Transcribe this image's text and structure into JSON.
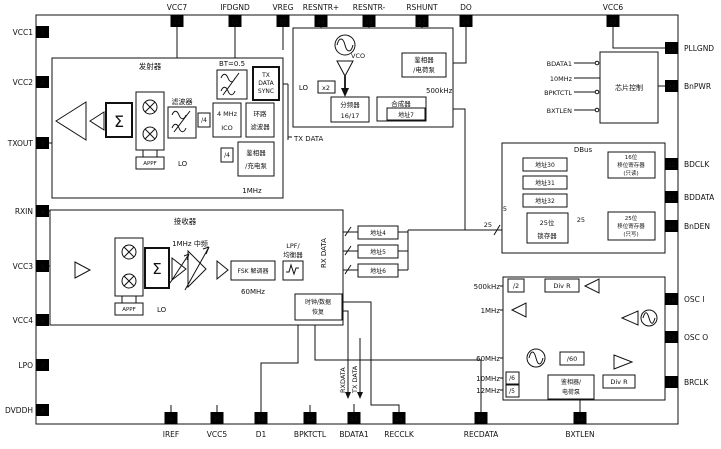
{
  "pins": {
    "left": [
      {
        "num": "1",
        "label": "VCC1"
      },
      {
        "num": "2",
        "label": "VCC2"
      },
      {
        "num": "3",
        "label": "TXOUT"
      },
      {
        "num": "4",
        "label": "RXIN"
      },
      {
        "num": "5",
        "label": "VCC3"
      },
      {
        "num": "6",
        "label": "VCC4"
      },
      {
        "num": "7",
        "label": "LPO"
      },
      {
        "num": "8",
        "label": "DVDDH"
      }
    ],
    "top": [
      {
        "num": "32",
        "label": "VCC7"
      },
      {
        "num": "31",
        "label": "IFDGND"
      },
      {
        "num": "30",
        "label": "VREG"
      },
      {
        "num": "29",
        "label": "RESNTR+"
      },
      {
        "num": "28",
        "label": "RESNTR-"
      },
      {
        "num": "27",
        "label": "RSHUNT"
      },
      {
        "num": "26",
        "label": "DO"
      },
      {
        "num": "25",
        "label": "VCC6"
      }
    ],
    "right": [
      {
        "num": "24",
        "label": "PLLGND"
      },
      {
        "num": "23",
        "label": "BnPWR"
      },
      {
        "num": "22",
        "label": "BDCLK"
      },
      {
        "num": "21",
        "label": "BDDATA"
      },
      {
        "num": "20",
        "label": "BnDEN"
      },
      {
        "num": "19",
        "label": "OSC I"
      },
      {
        "num": "18",
        "label": "OSC O"
      },
      {
        "num": "17",
        "label": "BRCLK"
      }
    ],
    "bottom": [
      {
        "num": "9",
        "label": "IREF"
      },
      {
        "num": "10",
        "label": "VCC5"
      },
      {
        "num": "11",
        "label": "D1"
      },
      {
        "num": "12",
        "label": "BPKTCTL"
      },
      {
        "num": "13",
        "label": "BDATA1"
      },
      {
        "num": "14",
        "label": "RECCLK"
      },
      {
        "num": "15",
        "label": "RECDATA"
      },
      {
        "num": "16",
        "label": "BXTLEN"
      }
    ]
  },
  "transmitter": {
    "title": "发射器",
    "sigma": "Σ",
    "bt_label": "BT=0.5",
    "sync_l1": "TX",
    "sync_l2": "DATA",
    "sync_l3": "SYNC",
    "filter_label": "滤波器",
    "div4_a": "/4",
    "div4_b": "/4",
    "ico_l1": "4 MHz",
    "ico_l2": "ICO",
    "loop_l1": "环路",
    "loop_l2": "滤波器",
    "pd_l1": "鉴相器",
    "pd_l2": "/充电泵",
    "ref_1mhz": "1MHz",
    "appf": "APPF",
    "lo": "LO"
  },
  "vco": {
    "vco_label": "VCO",
    "lo": "LO",
    "x2": "x2",
    "div_l1": "分频器",
    "div_l2": "16/17",
    "synth": "合成器",
    "addr7": "地址7",
    "pd_l1": "鉴相器",
    "pd_l2": "/电荷泵",
    "ref": "500kHz",
    "tx_data": "TX DATA"
  },
  "chip_control": {
    "title": "芯片控制",
    "in1": "BDATA1",
    "in2": "10MHz",
    "in3": "BPKTCTL",
    "in4": "BXTLEN"
  },
  "dbus": {
    "title": "DBus",
    "addr30": "地址30",
    "addr31": "地址31",
    "addr32": "地址32",
    "sr16_l1": "16位",
    "sr16_l2": "移位寄存器",
    "sr16_l3": "(只读)",
    "latch_l1": "25位",
    "latch_l2": "锁存器",
    "sr25_l1": "25位",
    "sr25_l2": "移位寄存器",
    "sr25_l3": "(只写)",
    "bus5": "5",
    "bus25_in": "25",
    "bus25_mid": "25"
  },
  "addr_mid": {
    "addr4": "地址4",
    "addr5": "地址5",
    "addr6": "地址6",
    "bus16_1": "16",
    "bus16_2": "16",
    "bus16_3": "16"
  },
  "receiver": {
    "title": "接收器",
    "sigma": "Σ",
    "if_label": "1MHz 中频",
    "fsk": "FSK 解调器",
    "freq_60": "60MHz",
    "lpf_l1": "LPF/",
    "lpf_l2": "均衡器",
    "rx_data": "RX DATA",
    "appf": "APPF",
    "lo": "LO",
    "cdr_l1": "时钟/数据",
    "cdr_l2": "恢复"
  },
  "bottom_labels": {
    "rxdata": "RXDATA",
    "txdata": "TX DATA"
  },
  "osc": {
    "f500k": "500kHz",
    "div2": "/2",
    "divr1": "Div R",
    "f1m": "1MHz",
    "f60m": "60MHz",
    "div60": "/60",
    "f10m": "10MHz",
    "div6": "/6",
    "f12m": "12MHz",
    "div5": "/5",
    "pd_l1": "鉴相器/",
    "pd_l2": "电荷泵",
    "divr2": "Div R"
  }
}
